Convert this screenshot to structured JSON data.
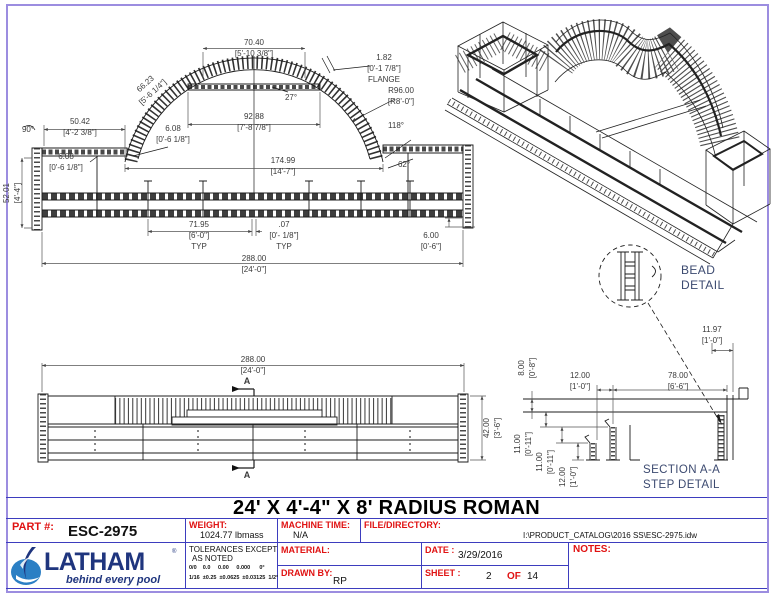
{
  "page": {
    "title": "24' X 4'-4\" X 8' RADIUS ROMAN"
  },
  "front_view": {
    "d70": [
      "70.40",
      "[5'-10 3/8\"]"
    ],
    "d66": [
      "66.23",
      "[5'-6 1/4\"]"
    ],
    "flange": [
      "1.82",
      "[0'-1 7/8\"]",
      "FLANGE"
    ],
    "radius": [
      "R96.00",
      "[R8'-0\"]"
    ],
    "a27": "27°",
    "a118": "118°",
    "a90": "90°",
    "a62": "62°",
    "d92": [
      "92.88",
      "[7'-8 7/8\"]"
    ],
    "d50": [
      "50.42",
      "[4'-2 3/8\"]"
    ],
    "d608a": [
      "6.08",
      "[0'-6 1/8\"]"
    ],
    "d608b": [
      "6.08",
      "[0'-6 1/8\"]"
    ],
    "d52": [
      "52.01",
      "[4'-4\"]"
    ],
    "d174": [
      "174.99",
      "[14'-7\"]"
    ],
    "d71": [
      "71.95",
      "[6'-0\"]",
      "TYP"
    ],
    "d07": [
      ".07",
      "[0'- 1/8\"]",
      "TYP"
    ],
    "d600": [
      "6.00",
      "[0'-6\"]"
    ],
    "d288": [
      "288.00",
      "[24'-0\"]"
    ]
  },
  "bottom_view": {
    "d288": [
      "288.00",
      "[24'-0\"]"
    ],
    "d42": [
      "42.00",
      "[3'-6\"]"
    ],
    "marker": "A"
  },
  "bead_detail": {
    "label": [
      "BEAD",
      "DETAIL"
    ]
  },
  "section_detail": {
    "d1197": [
      "11.97",
      "[1'-0\"]"
    ],
    "d800": [
      "8.00",
      "[0'-8\"]"
    ],
    "d1200": [
      "12.00",
      "[1'-0\"]"
    ],
    "d7800": [
      "78.00",
      "[6'-6\"]"
    ],
    "d1100a": [
      "11.00",
      "[0'-11\"]"
    ],
    "d1100b": [
      "11.00",
      "[0'-11\"]"
    ],
    "d1200b": [
      "12.00",
      "[1'-0\"]"
    ],
    "label": [
      "SECTION A-A",
      "STEP DETAIL"
    ]
  },
  "title_block": {
    "part_label": "PART #:",
    "part_value": "ESC-2975",
    "weight_label": "WEIGHT:",
    "weight_value": "1024.77 lbmass",
    "machine_label": "MACHINE TIME:",
    "machine_value": "N/A",
    "file_label": "FILE/DIRECTORY:",
    "file_value": "I:\\PRODUCT_CATALOG\\2016 SS\\ESC-2975.idw",
    "tol_label1": "TOLERANCES EXCEPT",
    "tol_label2": "AS NOTED",
    "tol_row1": "0/0    0.0     0.00     0.000      0°",
    "tol_row2": "1/16  ±0.25  ±0.0625  ±0.03125  1/2°",
    "material_label": "MATERIAL:",
    "drawn_label": "DRAWN BY:",
    "drawn_value": "RP",
    "date_label": "DATE :",
    "date_value": "3/29/2016",
    "sheet_label": "SHEET :",
    "sheet_value": "2",
    "sheet_of": "OF",
    "sheet_total": "14",
    "notes_label": "NOTES:"
  },
  "logo": {
    "name": "LATHAM",
    "reg": "®",
    "tagline": "behind every pool"
  },
  "colors": {
    "label_red": "#e01212",
    "line_blue": "#3d3dbe",
    "border_purple": "#9c8de0",
    "detail_navy": "#3c4a70",
    "logo_navy": "#1f357e",
    "logo_blue": "#2b7fc4",
    "linework": "#1c1c1c"
  }
}
